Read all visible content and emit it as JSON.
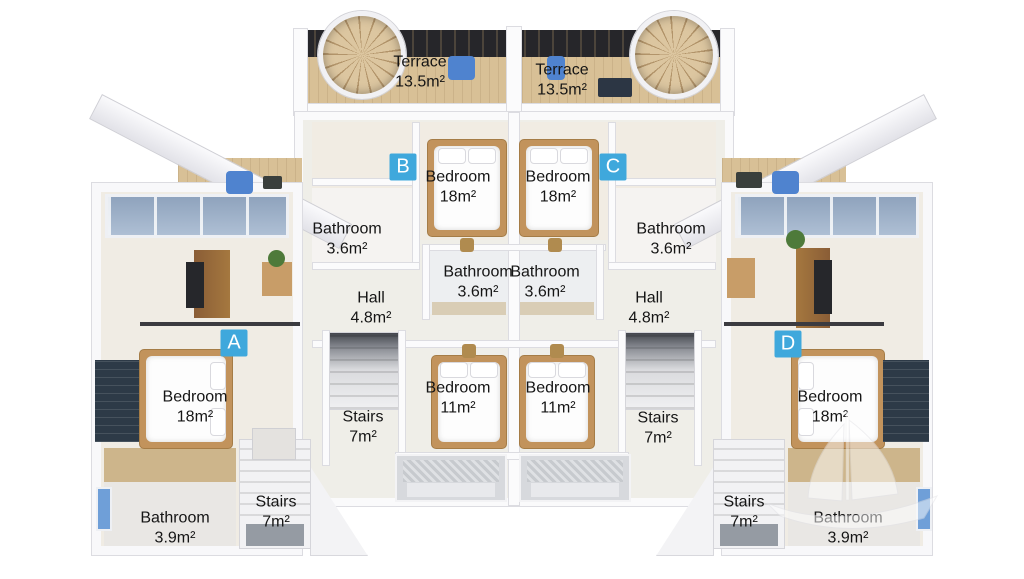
{
  "scene": {
    "type": "3d-floor-plan-render",
    "background": "#ffffff"
  },
  "badges": {
    "a": "A",
    "b": "B",
    "c": "C",
    "d": "D"
  },
  "rooms": {
    "terrace_left": {
      "name": "Terrace",
      "area": "13.5m²"
    },
    "terrace_right": {
      "name": "Terrace",
      "area": "13.5m²"
    },
    "bedroom_b": {
      "name": "Bedroom",
      "area": "18m²"
    },
    "bedroom_c": {
      "name": "Bedroom",
      "area": "18m²"
    },
    "bathroom_b": {
      "name": "Bathroom",
      "area": "3.6m²"
    },
    "bathroom_c": {
      "name": "Bathroom",
      "area": "3.6m²"
    },
    "bathroom_center_left": {
      "name": "Bathroom",
      "area": "3.6m²"
    },
    "bathroom_center_right": {
      "name": "Bathroom",
      "area": "3.6m²"
    },
    "hall_left": {
      "name": "Hall",
      "area": "4.8m²"
    },
    "hall_right": {
      "name": "Hall",
      "area": "4.8m²"
    },
    "bedroom_11_left": {
      "name": "Bedroom",
      "area": "11m²"
    },
    "bedroom_11_right": {
      "name": "Bedroom",
      "area": "11m²"
    },
    "stairs_mid_left": {
      "name": "Stairs",
      "area": "7m²"
    },
    "stairs_mid_right": {
      "name": "Stairs",
      "area": "7m²"
    },
    "stairs_lower_left": {
      "name": "Stairs",
      "area": "7m²"
    },
    "stairs_lower_right": {
      "name": "Stairs",
      "area": "7m²"
    },
    "bedroom_a": {
      "name": "Bedroom",
      "area": "18m²"
    },
    "bedroom_d": {
      "name": "Bedroom",
      "area": "18m²"
    },
    "bathroom_a": {
      "name": "Bathroom",
      "area": "3.9m²"
    },
    "bathroom_d": {
      "name": "Bathroom",
      "area": "3.9m²"
    }
  },
  "colors": {
    "badge_blue": "#3fa8dc",
    "wood_deck": "#d8c096",
    "floor_ivory": "#f0ece4",
    "wall_white": "#fafafb",
    "skylight_blue": "#9fb2ca",
    "furniture_blue": "#4f83cf",
    "dark_back_wall": "#26262a",
    "label_text": "#151515"
  },
  "icons": {
    "watermark": "sailing-ship-watermark"
  }
}
